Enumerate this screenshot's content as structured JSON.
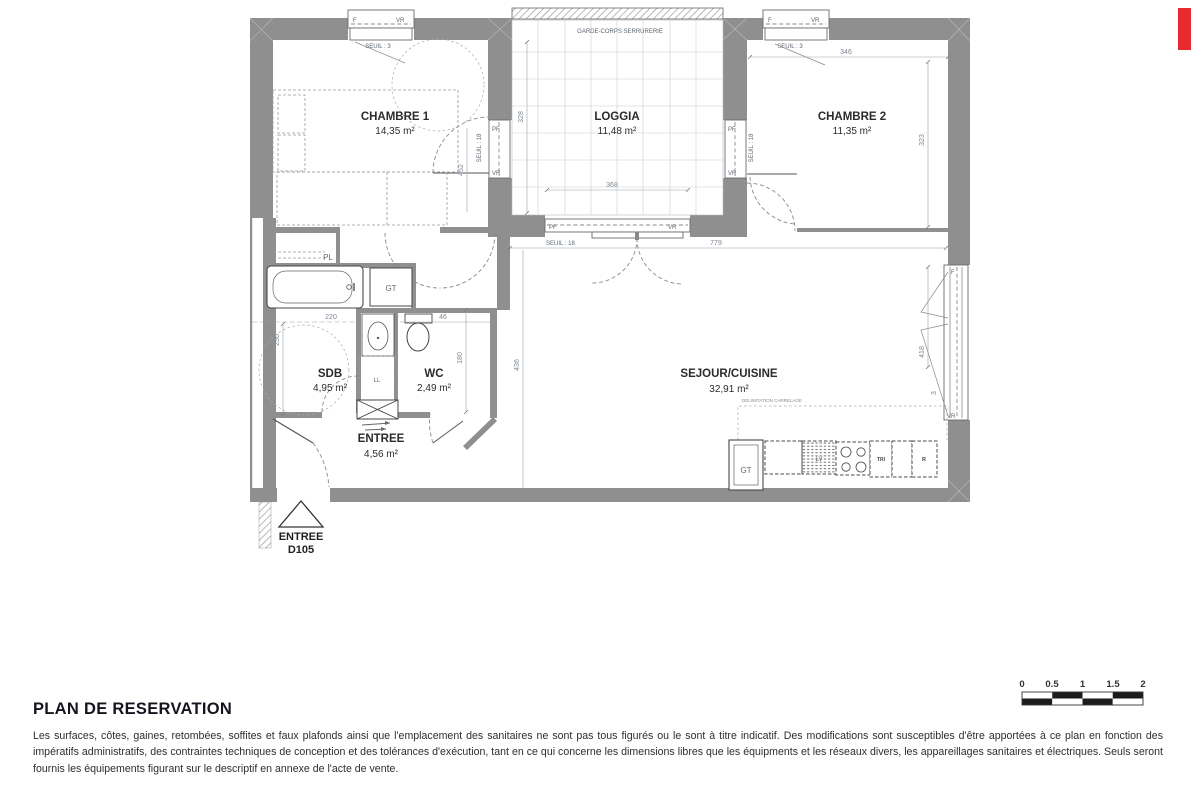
{
  "brand": {
    "red_mark_color": "#e62a2e"
  },
  "plan": {
    "rooms": {
      "chambre1": {
        "name": "CHAMBRE 1",
        "area": "14,35 m²"
      },
      "loggia": {
        "name": "LOGGIA",
        "area": "11,48 m²"
      },
      "chambre2": {
        "name": "CHAMBRE 2",
        "area": "11,35 m²"
      },
      "sdb": {
        "name": "SDB",
        "area": "4,95 m²"
      },
      "wc": {
        "name": "WC",
        "area": "2,49 m²"
      },
      "entree": {
        "name": "ENTREE",
        "area": "4,56 m²"
      },
      "sejour": {
        "name": "SEJOUR/CUISINE",
        "area": "32,91 m²"
      }
    },
    "annotations": {
      "garde_corps": "GARDE-CORPS SERRURERIE",
      "delimitation_carrelage": "DELIMITATION CARRELAGE"
    },
    "opening_labels": {
      "f": "F",
      "vr": "VR",
      "pf": "PF"
    },
    "thresholds": {
      "seuil3": "SEUIL : 3",
      "seuil18": "SEUIL : 18"
    },
    "fixtures": {
      "gt": "GT",
      "ll": "LL",
      "lv": "LV",
      "tri": "TRI",
      "r": "R",
      "pl": "PL"
    },
    "dimensions": {
      "chambre2_width": "346",
      "chambre2_depth": "323",
      "loggia_depth": "328",
      "loggia_width": "368",
      "sejour_width": "779",
      "sejour_depth": "436",
      "chambre1_bay": "452",
      "sejour_bay": "418",
      "sejour_bay_gap": "3",
      "sdb_width": "220",
      "sdb_depth": "250",
      "wc_width": "46",
      "wc_depth": "180"
    },
    "entrance": {
      "label": "ENTREE",
      "unit": "D105"
    }
  },
  "scale_bar": {
    "ticks": [
      "0",
      "0.5",
      "1",
      "1.5",
      "2"
    ]
  },
  "title_block": {
    "title": "PLAN DE RESERVATION",
    "disclaimer": "Les surfaces, côtes, gaines, retombées, soffites et faux plafonds ainsi que l'emplacement des sanitaires ne sont pas tous figurés ou le sont à titre indicatif. Des modifications sont susceptibles d'être apportées à ce plan en fonction des impératifs administratifs, des contraintes techniques de conception et des tolérances d'exécution, tant en ce qui concerne les dimensions libres que les équipments et les réseaux divers, les appareillages sanitaires et électriques. Seuls seront fournis les équipements figurant sur le descriptif en annexe de l'acte de vente."
  }
}
